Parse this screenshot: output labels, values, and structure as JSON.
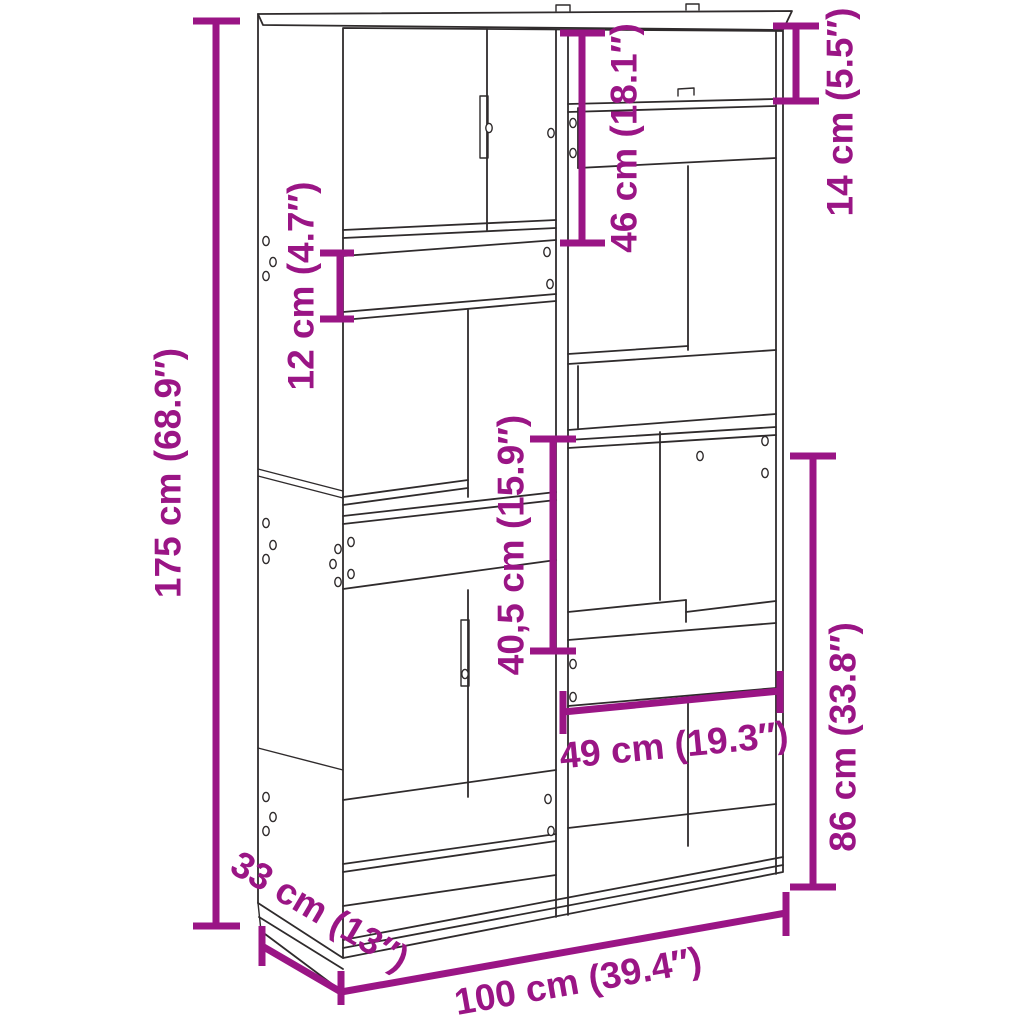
{
  "title": "Bookcase room divider dimension diagram",
  "colors": {
    "dimension": "#9A1585",
    "outline": "#2F2B2C",
    "background": "#FFFFFF"
  },
  "dimensions": {
    "overall_height": {
      "cm": "175",
      "inch": "68.9",
      "label": "175 cm (68.9″)"
    },
    "left_band_height": {
      "cm": "12",
      "inch": "4.7",
      "label": "12 cm (4.7″)"
    },
    "top_left_section_height": {
      "cm": "46",
      "inch": "18.1",
      "label": "46 cm (18.1″)"
    },
    "top_right_section_height": {
      "cm": "14",
      "inch": "5.5",
      "label": "14 cm (5.5″)"
    },
    "middle_compartment_height": {
      "cm": "40,5",
      "inch": "15.9",
      "label": "40,5 cm (15.9″)"
    },
    "lower_right_section_height": {
      "cm": "86",
      "inch": "33.8",
      "label": "86 cm (33.8″)"
    },
    "right_compartment_width": {
      "cm": "49",
      "inch": "19.3",
      "label": "49 cm (19.3″)"
    },
    "depth": {
      "cm": "33",
      "inch": "13",
      "label": "33 cm (13″)"
    },
    "overall_width": {
      "cm": "100",
      "inch": "39.4",
      "label": "100 cm (39.4″)"
    }
  }
}
